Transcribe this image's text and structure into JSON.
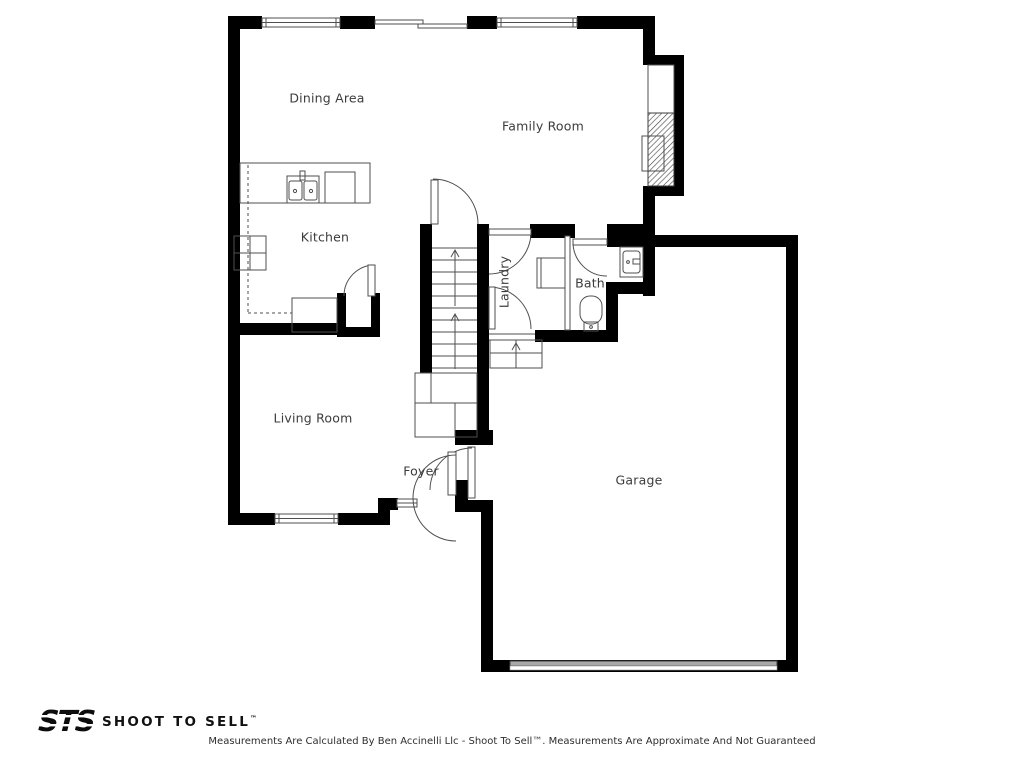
{
  "floorplan": {
    "rooms": [
      {
        "label": "Dining Area"
      },
      {
        "label": "Family Room"
      },
      {
        "label": "Kitchen"
      },
      {
        "label": "Laundry"
      },
      {
        "label": "Bath"
      },
      {
        "label": "Living Room"
      },
      {
        "label": "Foyer"
      },
      {
        "label": "Garage"
      }
    ]
  },
  "footer": {
    "logo": "STS",
    "brand": "SHOOT TO SELL",
    "trademark": "™",
    "disclaimer": "Measurements Are Calculated By Ben Accinelli Llc - Shoot To Sell™. Measurements Are Approximate And Not Guaranteed"
  },
  "colors": {
    "wall": "#000000",
    "line": "#4f4f4f",
    "label": "#3c3c3c"
  }
}
